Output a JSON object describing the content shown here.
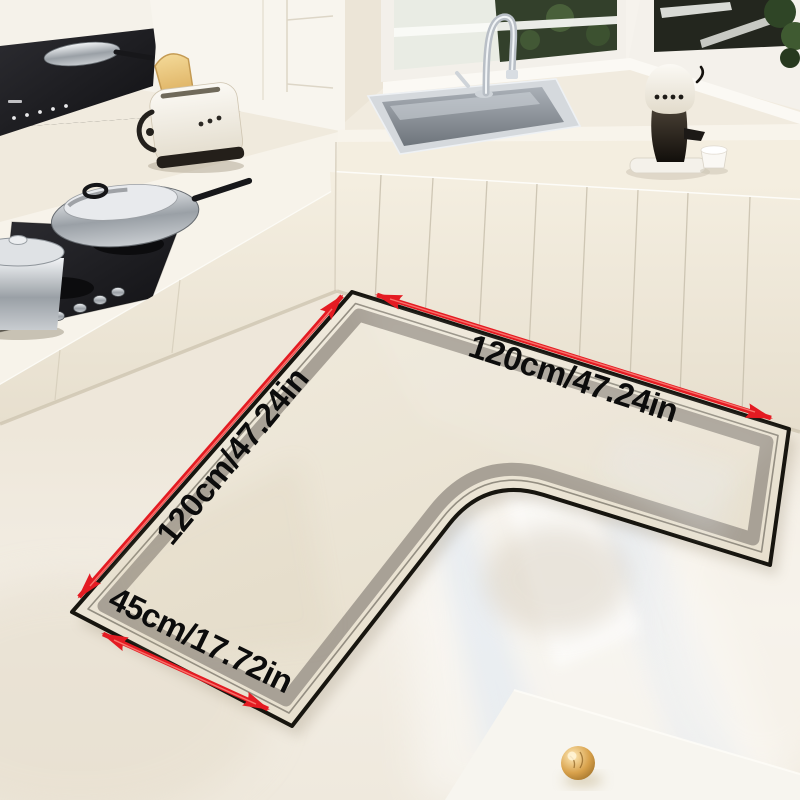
{
  "labels": {
    "top": "120cm/47.24in",
    "left": "120cm/47.24in",
    "bottom": "45cm/17.72in"
  },
  "icons": {
    "arrow_top": "double-headed-dimension-arrow",
    "arrow_left": "double-headed-dimension-arrow",
    "arrow_bottom": "double-headed-dimension-arrow"
  },
  "colors": {
    "arrow": "#e41b22",
    "arrow_highlight": "#ff8f85",
    "mat_surface": "#ebe4d4",
    "mat_band": "#a8a196",
    "mat_edge": "#17150f",
    "mat_thin_line": "#8a8478",
    "label_text": "#0c0c0c",
    "floor": "#f1ebe0",
    "cabinet": "#efe8da",
    "countertop": "#f7f3eb",
    "cooktop": "#232327"
  }
}
